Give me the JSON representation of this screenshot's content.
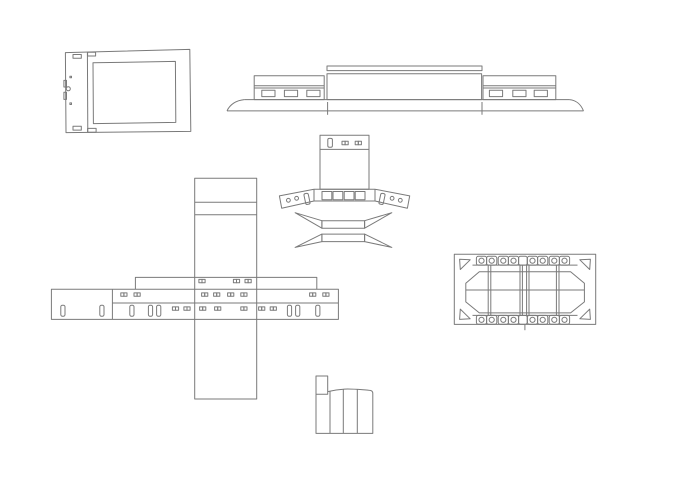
{
  "canvas": {
    "width": 679,
    "height": 480,
    "background": "#ffffff"
  },
  "drawing": {
    "type": "cad-line-drawing",
    "stroke_color": "#7a7a7a",
    "stroke_width": 1,
    "part_count": 6
  },
  "parts": [
    {
      "id": "back-panel",
      "name": "back panel with screen cutout"
    },
    {
      "id": "roof-profile",
      "name": "long side profile with window pods and flared base"
    },
    {
      "id": "hood-unfold",
      "name": "hood piece with winged band and bowtie strips"
    },
    {
      "id": "mast-cross",
      "name": "vertical mast crossed by slotted strip with bracket"
    },
    {
      "id": "chassis-plate",
      "name": "chassis plate with hole tabs and corner gussets"
    },
    {
      "id": "curved-bracket",
      "name": "small curved bracket strip with tab"
    }
  ]
}
